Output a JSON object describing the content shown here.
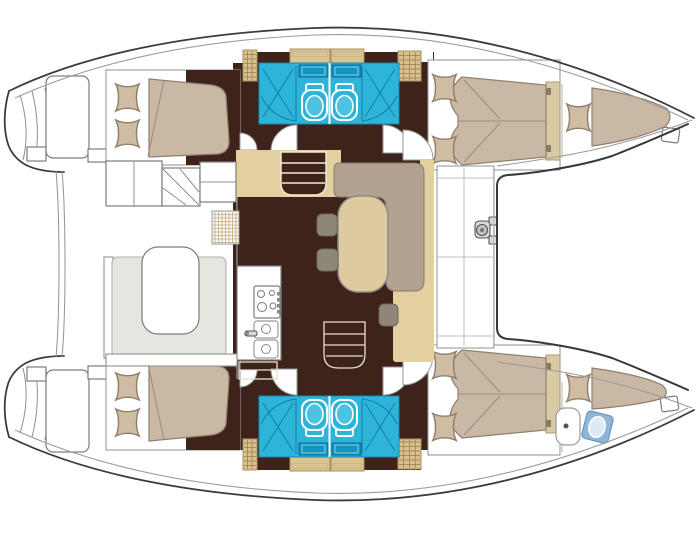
{
  "title": "Catamaran sailing yacht accommodation floor plan, top view with bow to the right",
  "canvas": {
    "width": 700,
    "height": 540
  },
  "colors": {
    "floor": "#3e231a",
    "tanfloor": "#e3d0a0",
    "locker": "#d8c08f",
    "cabinet": "#d9c492",
    "mattress": "#c9b8a4",
    "pillow": "#cfbca3",
    "sofa": "#b3a291",
    "table": "#ddca9f",
    "bath": "#2fb4d9",
    "bathdark": "#1694c0",
    "stool": "#8e8678",
    "platform": "#e7e5df",
    "crewtoilet": "#8fb5d8",
    "headboard": "#d9c9a4",
    "hullline": "#3c3c3c",
    "stairline": "#f2ead8"
  },
  "plan": {
    "orientation": {
      "bow": "right",
      "stern": "left",
      "port_hull": "top",
      "starboard_hull": "bottom"
    },
    "port_hull": {
      "aft_cabin": {
        "bed": "double",
        "pillows": 2
      },
      "bathrooms": [
        {
          "fixtures": [
            "shower",
            "toilet",
            "washbasin"
          ]
        },
        {
          "fixtures": [
            "shower",
            "toilet",
            "washbasin"
          ]
        }
      ],
      "forward_cabin": {
        "bed": "double",
        "pillows": 2
      },
      "bow_berth": {
        "bed": "wedge",
        "pillows": 1
      },
      "transom": {
        "swim_platform": true,
        "steps": true
      }
    },
    "starboard_hull": {
      "aft_cabin": {
        "bed": "double",
        "pillows": 2
      },
      "bathrooms": [
        {
          "fixtures": [
            "shower",
            "toilet",
            "washbasin"
          ]
        },
        {
          "fixtures": [
            "shower",
            "toilet",
            "washbasin"
          ]
        }
      ],
      "forward_cabin": {
        "bed": "double",
        "pillows": 2
      },
      "bow_berth": {
        "bed": "wedge",
        "pillows": 1,
        "extras": [
          "washbasin",
          "sea-toilet"
        ]
      },
      "transom": {
        "swim_platform": true,
        "steps": true
      }
    },
    "saloon": {
      "sofa": "L-shaped",
      "table": "oval",
      "stools": 3,
      "companionway_stairs": 2,
      "galley": {
        "stove_burners": 4,
        "sinks": 2,
        "faucet": 1,
        "under_counter_cabinet": 1
      }
    },
    "aft_cockpit": {
      "table": 1,
      "bench_platform": 1,
      "helm_steps": 1,
      "storage_boxes": 2,
      "deck_hatch": 1
    },
    "foredeck": {
      "bench_panels": 4,
      "trampoline": true,
      "windlass_fitting": 1,
      "bow_cleats": 2
    }
  }
}
